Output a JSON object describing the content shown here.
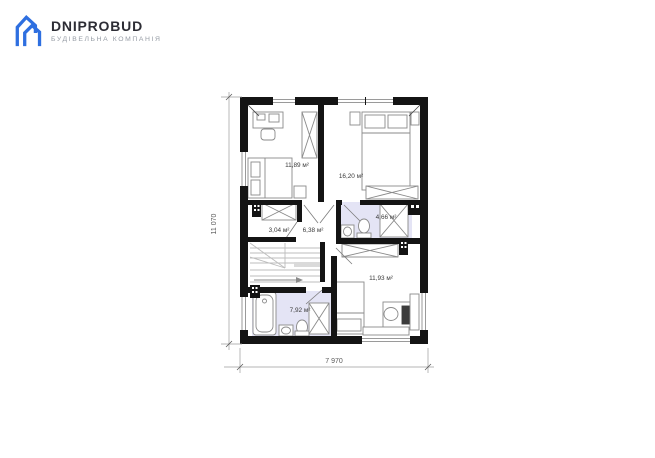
{
  "brand": {
    "name": "DNIPROBUD",
    "tagline": "БУДІВЕЛЬНА КОМПАНІЯ",
    "logo_color": "#2e6fe0",
    "name_color": "#2d2d35",
    "tagline_color": "#969ca5"
  },
  "plan": {
    "rooms": [
      {
        "id": "bedroom-top-left",
        "area": "11,89 м²"
      },
      {
        "id": "bedroom-top-right",
        "area": "16,20 м²"
      },
      {
        "id": "wardrobe",
        "area": "3,04 м²"
      },
      {
        "id": "hall",
        "area": "6,38 м²"
      },
      {
        "id": "bathroom-top",
        "area": "4,66 м²"
      },
      {
        "id": "bedroom-bottom",
        "area": "11,93 м²"
      },
      {
        "id": "bathroom-bottom",
        "area": "7,92 м²"
      }
    ],
    "dimensions": {
      "width": "7 970",
      "height": "11 070"
    },
    "colors": {
      "wall": "#141414",
      "bath_floor": "#e4e4f5",
      "furniture_stroke": "#8a8a8a",
      "dimension_line": "#9b9b9b"
    }
  }
}
